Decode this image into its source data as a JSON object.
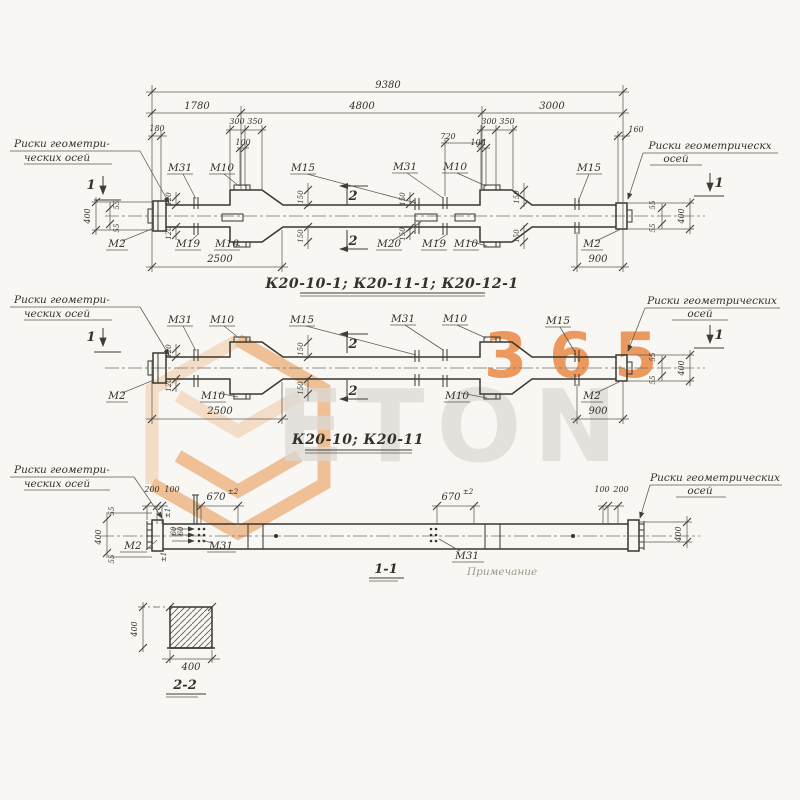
{
  "palette": {
    "paper": "#f8f7f3",
    "ink": "#38362f",
    "watermark_orange": "#e8883c",
    "watermark_orange_light": "#f2c49c",
    "watermark_gray": "#dbdad5"
  },
  "watermark": {
    "word": "ETON",
    "digits": "365"
  },
  "notes": {
    "l1": "Риски геометри-",
    "l2": "ческих осей",
    "r1": "Риски геометрических",
    "r1b": "Риски геометрическх",
    "r2": "осей"
  },
  "d1": {
    "title": "К20-10-1; К20-11-1; К20-12-1",
    "dim_total": "9380",
    "dim_seg1": "1780",
    "dim_seg2": "4800",
    "dim_seg3": "3000",
    "dim_180": "180",
    "dim_300": "300",
    "dim_350": "350",
    "dim_100": "100",
    "dim_720": "720",
    "dim_160": "160",
    "dim_2500": "2500",
    "dim_900": "900",
    "dim_400": "400",
    "dim_55": "55",
    "dim_120": "120",
    "dim_150": "150",
    "lbl_m31": "М31",
    "lbl_m10": "М10",
    "lbl_m15": "М15",
    "lbl_m19": "М19",
    "lbl_m20": "М20",
    "lbl_m2": "М2",
    "sec_1": "1",
    "sec_2": "2"
  },
  "d2": {
    "title": "К20-10; К20-11",
    "dim_2500": "2500",
    "dim_900": "900",
    "dim_120": "120",
    "dim_150": "150",
    "dim_400": "400",
    "dim_55": "55",
    "lbl_m31": "М31",
    "lbl_m10": "М10",
    "lbl_m15": "М15",
    "lbl_m2": "М2",
    "sec_1": "1",
    "sec_2": "2"
  },
  "d3": {
    "label": "1-1",
    "dim_200": "200",
    "dim_100": "100",
    "dim_670": "670",
    "tol": "±2",
    "pm1": "±1",
    "dim_60": "60",
    "dim_400": "400",
    "dim_55": "55",
    "lbl_m2": "М2",
    "lbl_m31": "М31",
    "remark": "Примечание"
  },
  "d4": {
    "label": "2-2",
    "dim_400": "400"
  }
}
